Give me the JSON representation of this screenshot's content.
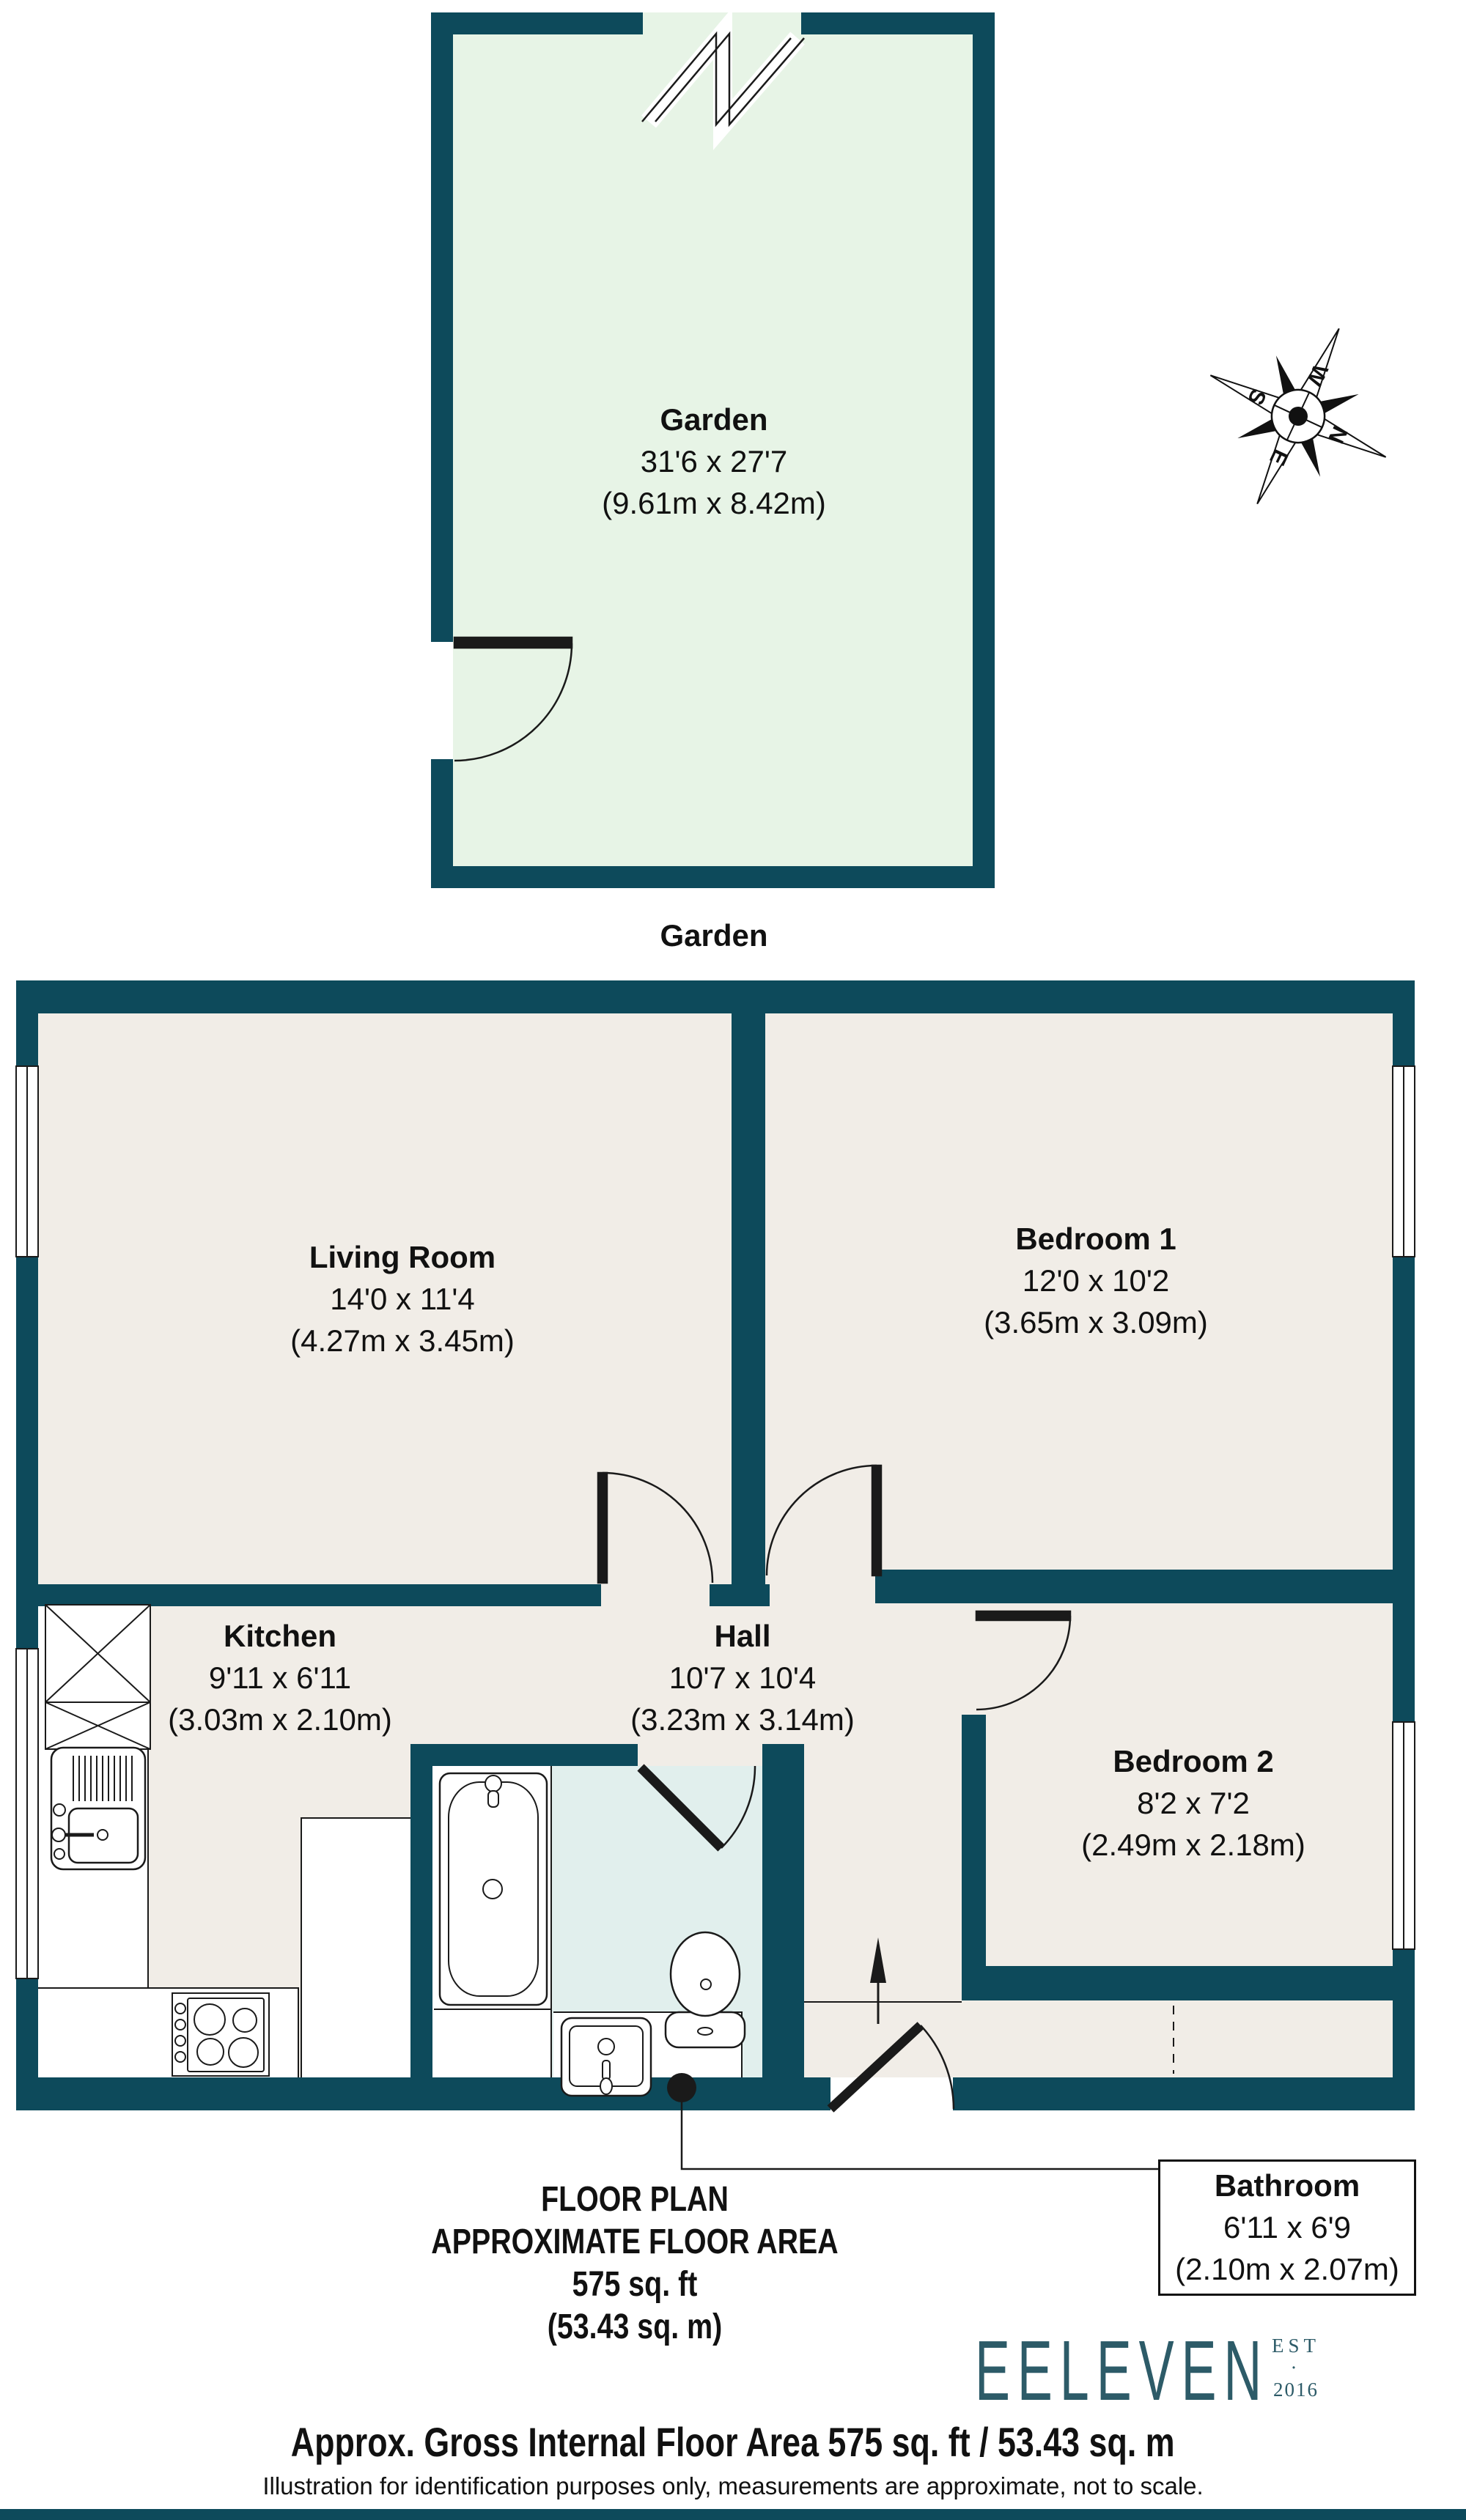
{
  "colors": {
    "wall": "#0d4a5b",
    "floor": "#f1ede7",
    "garden": "#e7f4e6",
    "bathroom_floor": "#e1efed",
    "line": "#1a1a1a",
    "brand": "#2d5b68"
  },
  "garden": {
    "name": "Garden",
    "dims_ft": "31'6 x 27'7",
    "dims_m": "(9.61m x 8.42m)",
    "caption": "Garden"
  },
  "rooms": {
    "living_room": {
      "name": "Living Room",
      "dims_ft": "14'0 x 11'4",
      "dims_m": "(4.27m x 3.45m)"
    },
    "bedroom1": {
      "name": "Bedroom 1",
      "dims_ft": "12'0 x 10'2",
      "dims_m": "(3.65m x 3.09m)"
    },
    "kitchen": {
      "name": "Kitchen",
      "dims_ft": "9'11 x 6'11",
      "dims_m": "(3.03m x 2.10m)"
    },
    "hall": {
      "name": "Hall",
      "dims_ft": "10'7 x 10'4",
      "dims_m": "(3.23m x 3.14m)"
    },
    "bedroom2": {
      "name": "Bedroom 2",
      "dims_ft": "8'2 x 7'2",
      "dims_m": "(2.49m x 2.18m)"
    },
    "bathroom": {
      "name": "Bathroom",
      "dims_ft": "6'11 x 6'9",
      "dims_m": "(2.10m x 2.07m)"
    }
  },
  "compass": {
    "north": "N",
    "east": "E",
    "south": "S",
    "west": "W"
  },
  "plan_note": {
    "title": "FLOOR PLAN",
    "subtitle": "APPROXIMATE FLOOR AREA",
    "area_ft": "575 sq. ft",
    "area_m": "(53.43 sq. m)"
  },
  "footer": {
    "brand": "EELEVEN",
    "brand_est": "EST",
    "brand_dot": "·",
    "brand_year": "2016",
    "gross_area": "Approx. Gross Internal Floor Area 575 sq. ft / 53.43 sq. m",
    "disclaimer": "Illustration for identification purposes only, measurements are approximate, not to scale."
  }
}
